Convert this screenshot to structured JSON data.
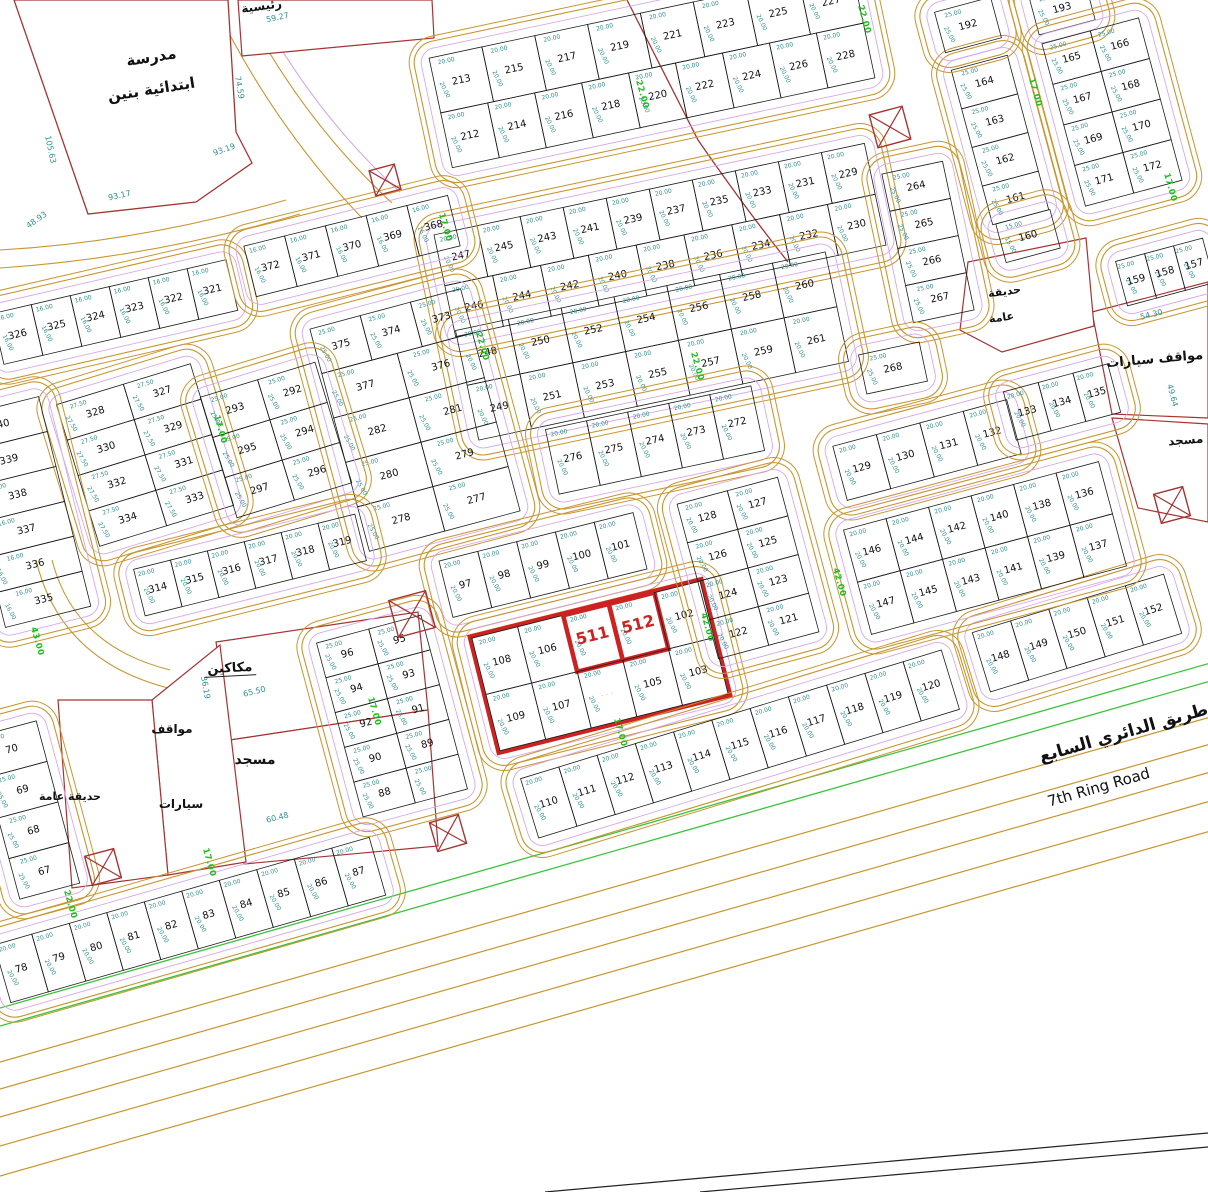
{
  "map": {
    "canvas": {
      "w": 1208,
      "h": 1192,
      "bg": "#ffffff"
    },
    "colors": {
      "road": "#c9952f",
      "road2": "#dcb060",
      "violet": "#d9a8e8",
      "parcel_line": "#1b1b1b",
      "number": "#111111",
      "dim": "#2f9090",
      "green": "#1fbf1f",
      "red": "#cc2222",
      "redline": "#a63333",
      "black": "#222222",
      "faint": "#bbbbbb"
    },
    "school": {
      "poly": [
        [
          14,
          0
        ],
        [
          228,
          0
        ],
        [
          236,
          132
        ],
        [
          252,
          163
        ],
        [
          196,
          202
        ],
        [
          88,
          214
        ]
      ],
      "label_line1": "مدرسة",
      "label_line2": "ابتدائية بنين",
      "x": 152,
      "y": 62,
      "rot": -9
    },
    "blocks": [
      {
        "n": "b213",
        "cx": 652,
        "cy": 68,
        "a": -12,
        "cw": 48,
        "ch": 56,
        "d": "20.00",
        "rows": [
          [
            "213",
            "215",
            "217",
            "219",
            "221",
            "223",
            "225",
            "227"
          ],
          [
            "212",
            "214",
            "216",
            "218",
            "220",
            "222",
            "224",
            "226",
            "228"
          ]
        ]
      },
      {
        "n": "b229",
        "cx": 660,
        "cy": 240,
        "a": -12,
        "cw": 44,
        "ch": 52,
        "d": "20.00",
        "rows": [
          [
            "247",
            "245",
            "243",
            "241",
            "239",
            "237",
            "235",
            "233",
            "231",
            "229"
          ],
          [
            "246",
            "244",
            "242",
            "240",
            "238",
            "236",
            "234",
            "232",
            "230"
          ]
        ]
      },
      {
        "n": "b248",
        "cx": 652,
        "cy": 346,
        "a": -12,
        "cw": 54,
        "ch": 56,
        "d": "20.00",
        "rows": [
          [
            "248",
            "250",
            "252",
            "254",
            "256",
            "258",
            "260"
          ],
          [
            "249",
            "251",
            "253",
            "255",
            "257",
            "259",
            "261"
          ]
        ]
      },
      {
        "n": "b264",
        "cx": 928,
        "cy": 242,
        "a": -12,
        "cw": 62,
        "ch": 38,
        "d": "25.00",
        "rows": [
          [
            "264"
          ],
          [
            "265"
          ],
          [
            "266"
          ],
          [
            "267"
          ]
        ]
      },
      {
        "n": "b268",
        "cx": 893,
        "cy": 368,
        "a": -12,
        "cw": 62,
        "ch": 40,
        "d": "25.00",
        "rows": [
          [
            "268"
          ]
        ]
      },
      {
        "n": "b272",
        "cx": 655,
        "cy": 440,
        "a": -12,
        "cw": 42,
        "ch": 66,
        "d": "20.00",
        "rows": [
          [
            "276",
            "275",
            "274",
            "273",
            "272"
          ]
        ]
      },
      {
        "n": "b277",
        "cx": 415,
        "cy": 420,
        "a": -15,
        "cw": 52,
        "ch": 46,
        "d": "25.00",
        "rows": [
          [
            "375",
            "374",
            "373"
          ],
          [
            "377",
            "376"
          ],
          [
            "282",
            "281"
          ],
          [
            "280",
            "279"
          ],
          [
            "278",
            "277"
          ]
        ]
      },
      {
        "n": "b321",
        "cx": 115,
        "cy": 312,
        "a": -13,
        "cw": 40,
        "ch": 52,
        "d": "16.00",
        "rows": [
          [
            "326",
            "325",
            "324",
            "323",
            "322",
            "321"
          ]
        ]
      },
      {
        "n": "b368",
        "cx": 352,
        "cy": 246,
        "a": -14,
        "cw": 42,
        "ch": 52,
        "d": "16.00",
        "rows": [
          [
            "372",
            "371",
            "370",
            "369",
            "368"
          ]
        ]
      },
      {
        "n": "b327",
        "cx": 145,
        "cy": 455,
        "a": -17,
        "cw": 70,
        "ch": 37,
        "d": "27.50",
        "rows": [
          [
            "328",
            "327"
          ],
          [
            "330",
            "329"
          ],
          [
            "332",
            "331"
          ],
          [
            "334",
            "333"
          ]
        ]
      },
      {
        "n": "b292",
        "cx": 276,
        "cy": 440,
        "a": -17,
        "cw": 60,
        "ch": 42,
        "d": "25.00",
        "rows": [
          [
            "293",
            "292"
          ],
          [
            "295",
            "294"
          ],
          [
            "297",
            "296"
          ]
        ]
      },
      {
        "n": "b335",
        "cx": 22,
        "cy": 512,
        "a": -14,
        "cw": 88,
        "ch": 36,
        "d": "16.00",
        "rows": [
          [
            "340"
          ],
          [
            "339"
          ],
          [
            "338"
          ],
          [
            "337"
          ],
          [
            "336"
          ],
          [
            "335"
          ]
        ]
      },
      {
        "n": "b314",
        "cx": 250,
        "cy": 565,
        "a": -14,
        "cw": 38,
        "ch": 48,
        "d": "20.00",
        "rows": [
          [
            "314",
            "315",
            "316",
            "317",
            "318",
            "319"
          ]
        ]
      },
      {
        "n": "b97",
        "cx": 543,
        "cy": 565,
        "a": -14,
        "cw": 40,
        "ch": 58,
        "d": "20.00",
        "rows": [
          [
            "97",
            "98",
            "99",
            "100",
            "101"
          ]
        ]
      },
      {
        "n": "b96",
        "cx": 392,
        "cy": 716,
        "a": -15,
        "cw": 54,
        "ch": 36,
        "d": "25.00",
        "rows": [
          [
            "96",
            "95"
          ],
          [
            "94",
            "93"
          ],
          [
            "92",
            "91"
          ],
          [
            "90",
            "89"
          ],
          [
            "88",
            null
          ]
        ]
      },
      {
        "n": "b511",
        "cx": 600,
        "cy": 666,
        "a": -14,
        "cw": 47,
        "ch": 58,
        "d": "20.00",
        "hl": true,
        "rows": [
          [
            "108",
            "106",
            "511",
            "512",
            "102"
          ],
          [
            "109",
            "107",
            "~",
            "105",
            "103"
          ]
        ]
      },
      {
        "n": "b110",
        "cx": 740,
        "cy": 744,
        "a": -17,
        "cw": 40,
        "ch": 62,
        "d": "20.00",
        "rows": [
          [
            "110",
            "111",
            "112",
            "113",
            "114",
            "115",
            "116",
            "117",
            "118",
            "119",
            "120"
          ]
        ]
      },
      {
        "n": "b148",
        "cx": 1077,
        "cy": 633,
        "a": -17,
        "cw": 40,
        "ch": 62,
        "d": "20.00",
        "rows": [
          [
            "148",
            "149",
            "150",
            "151",
            "152"
          ]
        ]
      },
      {
        "n": "b121",
        "cx": 748,
        "cy": 568,
        "a": -15,
        "cw": 52,
        "ch": 40,
        "d": "20.00",
        "rows": [
          [
            "128",
            "127"
          ],
          [
            "126",
            "125"
          ],
          [
            "124",
            "123"
          ],
          [
            "122",
            "121"
          ]
        ]
      },
      {
        "n": "b129",
        "cx": 927,
        "cy": 450,
        "a": -15,
        "cw": 45,
        "ch": 56,
        "d": "20.00",
        "rows": [
          [
            "129",
            "130",
            "131",
            "132"
          ]
        ]
      },
      {
        "n": "b133",
        "cx": 1062,
        "cy": 402,
        "a": -15,
        "cw": 36,
        "ch": 50,
        "d": "20.00",
        "rows": [
          [
            "133",
            "134",
            "135"
          ]
        ]
      },
      {
        "n": "b136",
        "cx": 985,
        "cy": 548,
        "a": -15,
        "cw": 44,
        "ch": 54,
        "d": "20.00",
        "rows": [
          [
            "146",
            "144",
            "142",
            "140",
            "138",
            "136"
          ],
          [
            "147",
            "145",
            "143",
            "141",
            "139",
            "137"
          ]
        ]
      },
      {
        "n": "b161",
        "cx": 1000,
        "cy": 140,
        "a": -15,
        "cw": 58,
        "ch": 40,
        "d": "25.00",
        "rows": [
          [
            "164"
          ],
          [
            "163"
          ],
          [
            "162"
          ],
          [
            "161"
          ]
        ]
      },
      {
        "n": "b192",
        "cx": 968,
        "cy": 25,
        "a": -15,
        "cw": 58,
        "ch": 42,
        "d": "25.00",
        "rows": [
          [
            "192"
          ]
        ]
      },
      {
        "n": "b193",
        "cx": 1062,
        "cy": 8,
        "a": -15,
        "cw": 58,
        "ch": 40,
        "d": "25.00",
        "rows": [
          [
            "193"
          ]
        ]
      },
      {
        "n": "b165",
        "cx": 1112,
        "cy": 112,
        "a": -15,
        "cw": 50,
        "ch": 42,
        "d": "25.00",
        "rows": [
          [
            "165",
            "166"
          ],
          [
            "167",
            "168"
          ],
          [
            "169",
            "170"
          ],
          [
            "171",
            "172"
          ]
        ]
      },
      {
        "n": "b157",
        "cx": 1165,
        "cy": 272,
        "a": -15,
        "cw": 30,
        "ch": 46,
        "d": "25.00",
        "rows": [
          [
            "159",
            "158",
            "157"
          ]
        ]
      },
      {
        "n": "b160",
        "cx": 1028,
        "cy": 236,
        "a": -15,
        "cw": 56,
        "ch": 40,
        "d": "15.00",
        "rows": [
          [
            "160"
          ]
        ]
      },
      {
        "n": "b67",
        "cx": 28,
        "cy": 810,
        "a": -15,
        "cw": 62,
        "ch": 42,
        "d": "25.00",
        "rows": [
          [
            "70"
          ],
          [
            "69"
          ],
          [
            "68"
          ],
          [
            "67"
          ]
        ]
      },
      {
        "n": "b78",
        "cx": 190,
        "cy": 920,
        "a": -16,
        "cw": 39,
        "ch": 60,
        "d": "20.00",
        "rows": [
          [
            "78",
            "79",
            "80",
            "81",
            "82",
            "83",
            "84",
            "85",
            "86",
            "87"
          ]
        ]
      }
    ],
    "highlight_plots": [
      "511",
      "512"
    ],
    "xboxes": [
      [
        385,
        180,
        26,
        -15
      ],
      [
        890,
        127,
        34,
        -15
      ],
      [
        1172,
        505,
        30,
        -15
      ],
      [
        412,
        614,
        38,
        -15
      ],
      [
        448,
        833,
        30,
        -16
      ],
      [
        103,
        867,
        30,
        -15
      ]
    ],
    "green_labels": [
      [
        640,
        95,
        "22.00"
      ],
      [
        443,
        228,
        "17.00"
      ],
      [
        218,
        430,
        "17.00"
      ],
      [
        480,
        347,
        "22.00"
      ],
      [
        705,
        628,
        "42.00"
      ],
      [
        35,
        642,
        "43.00"
      ],
      [
        372,
        712,
        "17.00"
      ],
      [
        207,
        863,
        "17.00"
      ],
      [
        68,
        905,
        "22.00"
      ],
      [
        862,
        20,
        "22.00"
      ],
      [
        1168,
        188,
        "17.00"
      ],
      [
        1033,
        93,
        "17.00"
      ],
      [
        837,
        583,
        "42.00"
      ],
      [
        618,
        733,
        "17.00"
      ],
      [
        695,
        367,
        "22.00"
      ]
    ],
    "dim_labels": [
      [
        48,
        150,
        "105.63",
        78
      ],
      [
        237,
        88,
        "74.59",
        80
      ],
      [
        225,
        152,
        "93.19",
        -20
      ],
      [
        120,
        198,
        "93.17",
        -12
      ],
      [
        38,
        222,
        "48.93",
        -35
      ],
      [
        278,
        20,
        "59.27",
        -12
      ],
      [
        255,
        694,
        "65.50",
        -14
      ],
      [
        278,
        820,
        "60.48",
        -14
      ],
      [
        1152,
        317,
        "54.30",
        -14
      ],
      [
        1170,
        396,
        "49.64",
        75
      ],
      [
        203,
        688,
        "36.19",
        80
      ]
    ],
    "ar_labels": [
      {
        "x": 230,
        "y": 672,
        "t": "مكاكين",
        "s": 13,
        "r": -3,
        "u": true
      },
      {
        "x": 172,
        "y": 733,
        "t": "مواقف",
        "s": 12,
        "r": 0,
        "u": false
      },
      {
        "x": 181,
        "y": 808,
        "t": "سيارات",
        "s": 12,
        "r": 0,
        "u": false
      },
      {
        "x": 255,
        "y": 764,
        "t": "مسجد",
        "s": 14,
        "r": 0,
        "u": false
      },
      {
        "x": 70,
        "y": 800,
        "t": "حديقة عامة",
        "s": 11,
        "r": 0,
        "u": false
      },
      {
        "x": 1155,
        "y": 363,
        "t": "مواقف سيارات",
        "s": 13,
        "r": -5,
        "u": false
      },
      {
        "x": 1186,
        "y": 444,
        "t": "مسجد",
        "s": 12,
        "r": -5,
        "u": false
      },
      {
        "x": 1005,
        "y": 295,
        "t": "حديقة",
        "s": 11,
        "r": -8,
        "u": false
      },
      {
        "x": 1002,
        "y": 321,
        "t": "عامة",
        "s": 11,
        "r": -8,
        "u": false
      },
      {
        "x": 262,
        "y": 10,
        "t": "رئيسية",
        "s": 12,
        "r": -8,
        "u": false
      }
    ],
    "ring_road": {
      "slope": -0.285,
      "green_b": [
        1008,
        1026
      ],
      "orange_b": [
        1062,
        1089,
        1117,
        1146,
        1176
      ],
      "black_lines": [
        [
          545,
          1192,
          1208,
          1133
        ],
        [
          700,
          1192,
          1208,
          1147
        ]
      ],
      "label_en": "7th Ring Road",
      "label_ar": "طريق الدائري السابع",
      "en_pos": [
        1100,
        792,
        -16
      ],
      "ar_pos": [
        1125,
        738,
        -16
      ]
    },
    "road_curves": [
      {
        "p": "M 240,0 Q 300,118 392,203",
        "c": "o"
      },
      {
        "p": "M 212,0 Q 272,124 362,218",
        "c": "o"
      },
      {
        "p": "M 253,0 Q 312,112 400,192",
        "c": "v"
      },
      {
        "p": "M 0,250 Q 140,242 286,200",
        "c": "o"
      },
      {
        "p": "M 0,268 Q 150,258 300,214",
        "c": "o"
      },
      {
        "p": "M 627,0 L 698,140 Q 745,208 788,262",
        "c": "r"
      },
      {
        "p": "M 52,560 Q 74,646 170,670",
        "c": "o"
      },
      {
        "p": "M 36,560 Q 60,660 168,688",
        "c": "o"
      }
    ],
    "red_polys": [
      {
        "n": "shops-parcel",
        "pts": [
          [
            216,
            642
          ],
          [
            418,
            612
          ],
          [
            428,
            710
          ],
          [
            230,
            740
          ]
        ]
      },
      {
        "n": "mosque-left-parcel",
        "pts": [
          [
            230,
            740
          ],
          [
            428,
            710
          ],
          [
            438,
            846
          ],
          [
            244,
            864
          ]
        ]
      },
      {
        "n": "parking-left-parcel",
        "pts": [
          [
            152,
            700
          ],
          [
            220,
            645
          ],
          [
            246,
            862
          ],
          [
            168,
            875
          ]
        ]
      },
      {
        "n": "garden-left-parcel",
        "pts": [
          [
            58,
            700
          ],
          [
            152,
            700
          ],
          [
            168,
            875
          ],
          [
            72,
            888
          ]
        ]
      },
      {
        "n": "parking-right-parcel",
        "pts": [
          [
            1092,
            312
          ],
          [
            1208,
            282
          ],
          [
            1208,
            418
          ],
          [
            1112,
            414
          ]
        ]
      },
      {
        "n": "mosque-right-parcel",
        "pts": [
          [
            1112,
            418
          ],
          [
            1208,
            424
          ],
          [
            1208,
            522
          ],
          [
            1138,
            508
          ]
        ]
      },
      {
        "n": "garden-right-parcel",
        "pts": [
          [
            968,
            262
          ],
          [
            1086,
            238
          ],
          [
            1094,
            326
          ],
          [
            1002,
            352
          ],
          [
            960,
            330
          ]
        ]
      },
      {
        "n": "top-cut-parcel",
        "pts": [
          [
            238,
            0
          ],
          [
            432,
            0
          ],
          [
            434,
            38
          ],
          [
            242,
            56
          ]
        ]
      }
    ]
  }
}
